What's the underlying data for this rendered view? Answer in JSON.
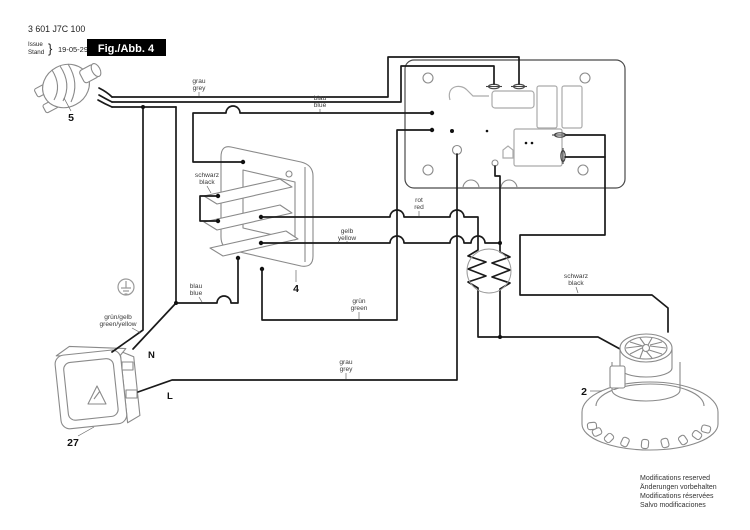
{
  "title_block": {
    "part_number": "3 601 J7C 100",
    "issue_label": "Issue",
    "stand_label": "Stand",
    "brace": "}",
    "date": "19-05-29",
    "figure_label": "Fig./Abb. 4"
  },
  "wire_labels": {
    "grey_top": {
      "de": "grau",
      "en": "grey"
    },
    "blue_top": {
      "de": "blau",
      "en": "blue"
    },
    "black_switch": {
      "de": "schwarz",
      "en": "black"
    },
    "yellow": {
      "de": "gelb",
      "en": "yellow"
    },
    "red": {
      "de": "rot",
      "en": "red"
    },
    "blue_lower": {
      "de": "blau",
      "en": "blue"
    },
    "green": {
      "de": "grün",
      "en": "green"
    },
    "green_yellow": {
      "de": "grün/gelb",
      "en": "green/yellow"
    },
    "grey_lower": {
      "de": "grau",
      "en": "grey"
    },
    "black_motor": {
      "de": "schwarz",
      "en": "black"
    }
  },
  "part_labels": {
    "plug": "5",
    "switch": "4",
    "motor": "2",
    "socket": "27"
  },
  "terminal_labels": {
    "neutral": "N",
    "line": "L"
  },
  "footer": [
    "Modifications reserved",
    "Änderungen vorbehalten",
    "Modifications réservées",
    "Salvo modificaciones"
  ],
  "colors": {
    "wire": "#1a1a1a",
    "component_outline": "#8a8a8a",
    "label_text": "#3a3a3a",
    "figure_box_bg": "#000000",
    "figure_box_text": "#ffffff"
  }
}
